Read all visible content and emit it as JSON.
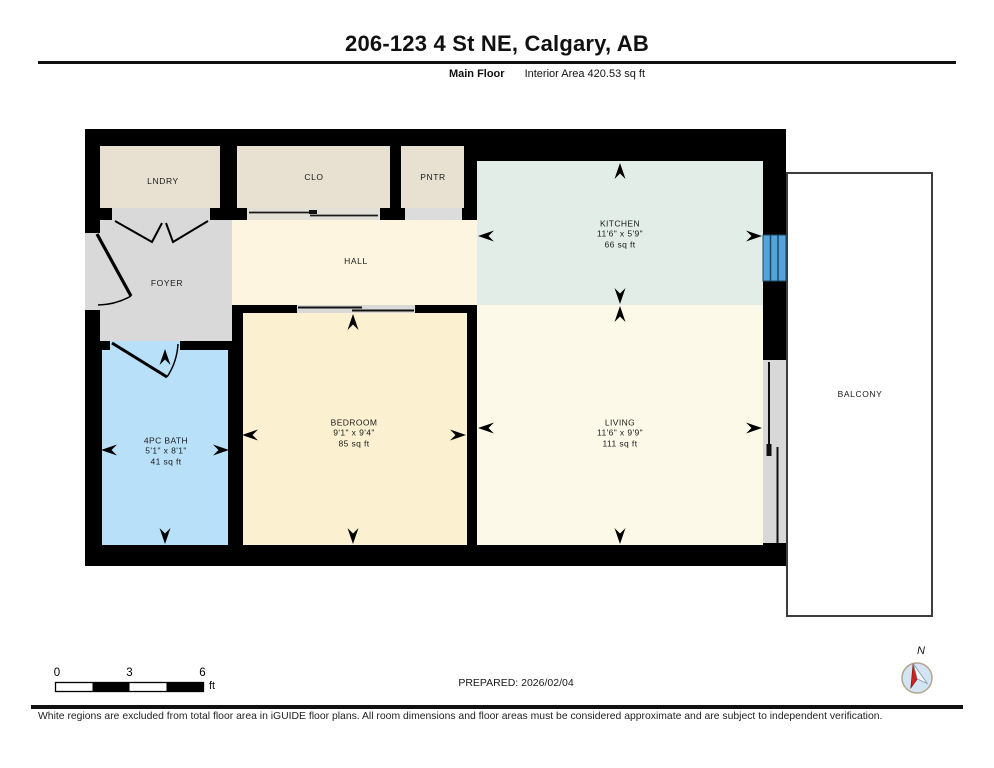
{
  "header": {
    "title": "206-123 4 St NE, Calgary, AB",
    "floor_label": "Main Floor",
    "area_label": "Interior Area 420.53 sq ft"
  },
  "rooms": {
    "lndry": {
      "name": "LNDRY"
    },
    "clo": {
      "name": "CLO"
    },
    "pntr": {
      "name": "PNTR"
    },
    "foyer": {
      "name": "FOYER"
    },
    "hall": {
      "name": "HALL"
    },
    "kitchen": {
      "name": "KITCHEN",
      "dims": "11'6\" x 5'9\"",
      "area": "66 sq ft"
    },
    "bedroom": {
      "name": "BEDROOM",
      "dims": "9'1\" x 9'4\"",
      "area": "85 sq ft"
    },
    "living": {
      "name": "LIVING",
      "dims": "11'6\" x 9'9\"",
      "area": "111 sq ft"
    },
    "bath": {
      "name": "4PC BATH",
      "dims": "5'1\" x 8'1\"",
      "area": "41 sq ft"
    },
    "balcony": {
      "name": "BALCONY"
    }
  },
  "scale_bar": {
    "start": "0",
    "mid": "3",
    "end": "6",
    "unit": "ft"
  },
  "prepared_label": "PREPARED: 2026/02/04",
  "compass": {
    "north_label": "N"
  },
  "footer_note": "White regions are excluded from total floor area in iGUIDE floor plans. All room dimensions and floor areas must be considered approximate and are subject to independent verification.",
  "colors": {
    "wall": "#000000",
    "closet_fill": "#e8e1d2",
    "foyer_fill": "#d9d9d9",
    "hall_fill": "#fdf5df",
    "kitchen_fill": "#e2ede8",
    "bedroom_fill": "#fbf0d0",
    "living_fill": "#fdf9e8",
    "bath_fill": "#b9e0f9",
    "window_blue": "#54a3db",
    "compass_red": "#cc2222"
  }
}
